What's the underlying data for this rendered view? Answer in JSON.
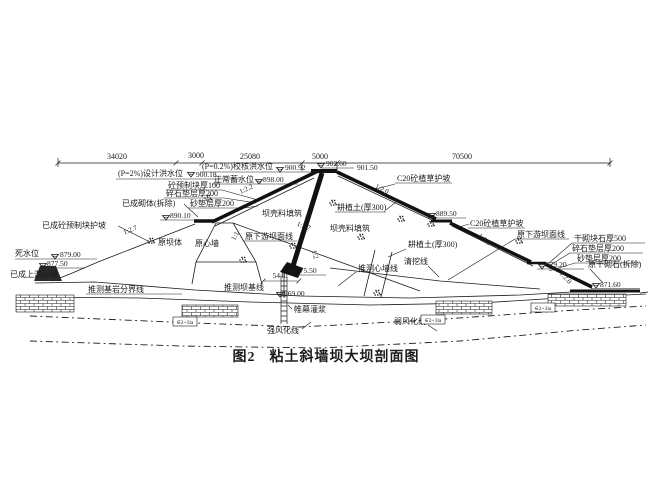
{
  "caption": {
    "fig_no": "图2",
    "title": "粘土斜墙坝大坝剖面图"
  },
  "dimensions": {
    "d34020": "34020",
    "d3000": "3000",
    "d25080": "25080",
    "d5000": "5000",
    "d70500": "70500",
    "base_width": "5440"
  },
  "levels": {
    "design_flood_label": "(P=2%)设计洪水位",
    "design_flood": "900.18",
    "check_flood_label": "(P=0.2%)校核洪水位",
    "check_flood": "900.92",
    "normal_label": "正常蓄水位",
    "normal": "898.00",
    "dead_label": "死水位",
    "dead": "879.00",
    "dead2": "877.50",
    "crest": "902.60",
    "crest_dn": "901.50",
    "up_berm": "890.10",
    "dn_berm1": "889.50",
    "dn_berm2": "879.20",
    "platform": "871.60",
    "wall_bottom": "875.50",
    "foundation": "869.00"
  },
  "labels": {
    "precast_block": "砼预制块厚100",
    "gravel_cushion": "碎石垫层厚200",
    "sand_cushion": "砂垫层厚200",
    "existing_masonry": "已成砌体(拆除)",
    "existing_precast_slope": "已成砼预制块护坡",
    "cofferdam": "已成上游围堰",
    "old_dam_body": "原坝体",
    "old_core_wall": "原心墙",
    "old_downstream_face": "原下游坝面线",
    "shell_fill": "坝壳料填筑",
    "topsoil": "耕植土(厚300)",
    "c20_grass_slope": "C20砼植草护坡",
    "inferred_bedrock": "推测基岩分界线",
    "inferred_dam_base": "推测坝基线",
    "inferred_core_line": "推测心墙线",
    "clearing_line": "清挖线",
    "grout_curtain": "帷幕灌浆",
    "strong_weathering": "强风化线",
    "weak_weathering": "弱风化线",
    "dry_block_stone": "干砌块石厚500",
    "old_dry_stone": "原干砌石(拆除)",
    "geo_code": "∈2+3la"
  },
  "slopes": {
    "s1": "1:2.2",
    "s2": "1:2.7",
    "s3": "1:1",
    "s4": "1:2.7",
    "s5": "1:2.0",
    "s6": "1:2",
    "s7": "1:2.0",
    "s8": "1:2.0"
  },
  "colors": {
    "ink": "#1b1b1b",
    "background": "#ffffff"
  }
}
